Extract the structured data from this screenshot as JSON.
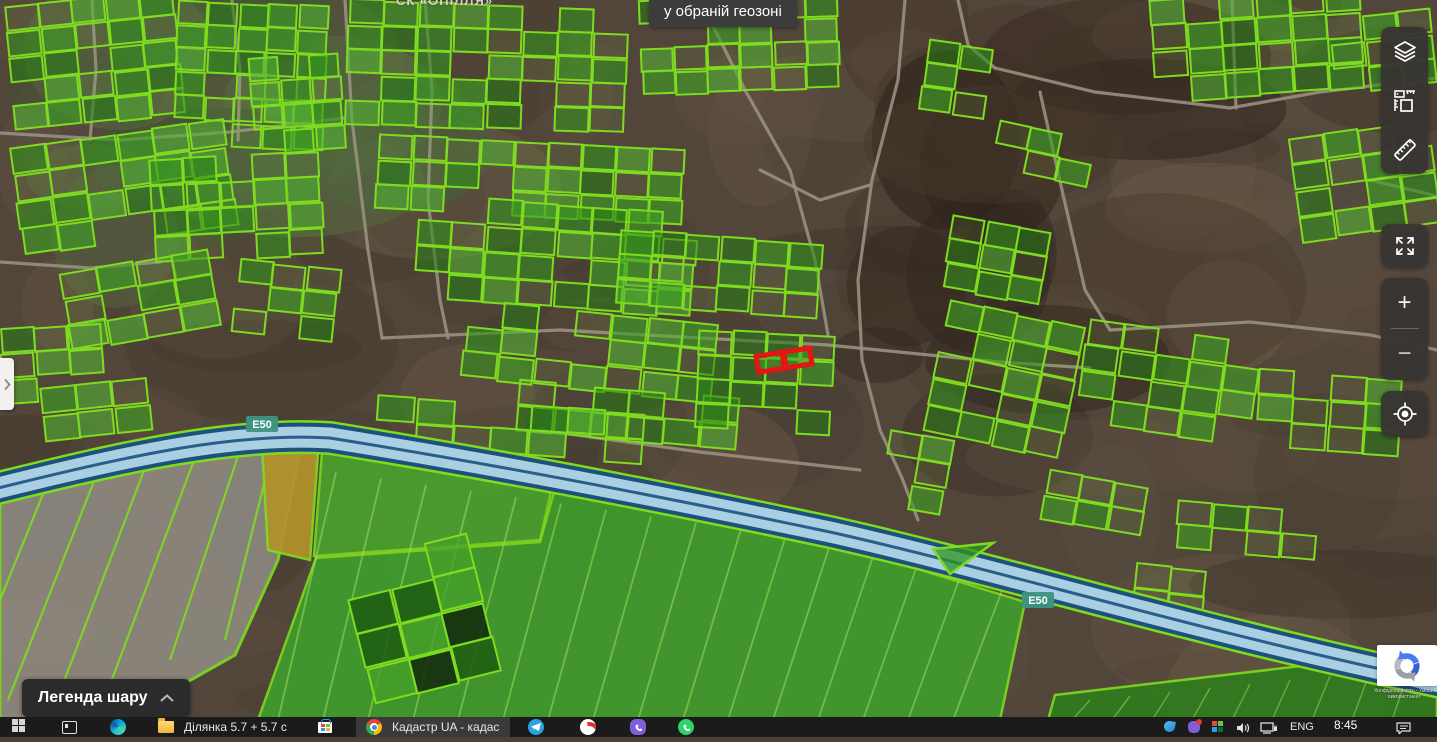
{
  "tooltip": {
    "text": "у обраній геозоні"
  },
  "map_overlay": {
    "area_label": "СК «ОПІЛЛЯ»",
    "road_badge": "E50",
    "highlight_color": "#e61414",
    "parcel_stroke": "#7fdb1f",
    "road_badge_color": "#3e9383"
  },
  "right_toolbar": {
    "icons": [
      "layers-icon",
      "map-legend-icon",
      "measure-ruler-icon",
      "fullscreen-icon",
      "zoom-in",
      "zoom-out",
      "locate-icon"
    ],
    "zoom_in_glyph": "+",
    "zoom_out_glyph": "−"
  },
  "left_tab": {
    "chevron_glyph": "❯"
  },
  "legend_button": {
    "label": "Легенда шару"
  },
  "recaptcha": {
    "privacy_terms": "Конфіденційність - Умови використання"
  },
  "taskbar": {
    "folder_window_label": "Ділянка 5.7 + 5.7 с",
    "active_window_label": "Кадастр UA - кадас",
    "tray": {
      "language": "ENG",
      "time": "8:45"
    }
  }
}
